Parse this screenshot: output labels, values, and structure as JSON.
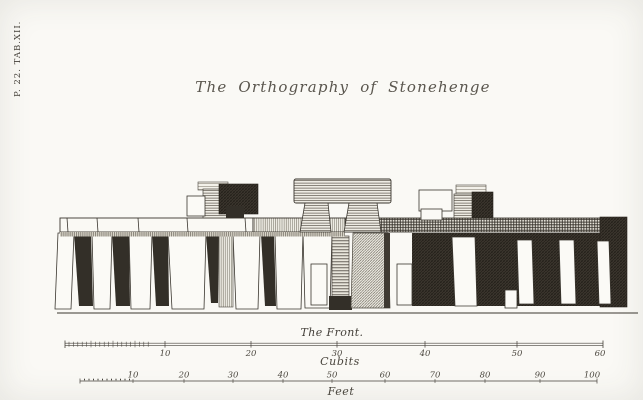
{
  "plate_ref": "P. 22. TAB.XII.",
  "title": "The Orthography of Stonehenge",
  "front_label": "The Front.",
  "scales": {
    "cubits": {
      "label": "Cubits",
      "ticks": [
        "10",
        "20",
        "30",
        "40",
        "50",
        "60"
      ]
    },
    "feet": {
      "label": "Feet",
      "ticks": [
        "10",
        "20",
        "30",
        "40",
        "50",
        "60",
        "70",
        "80",
        "90",
        "100"
      ]
    }
  },
  "colors": {
    "paper": "#faf9f5",
    "ink": "#35312a",
    "shadow_dark": "#332f28"
  }
}
